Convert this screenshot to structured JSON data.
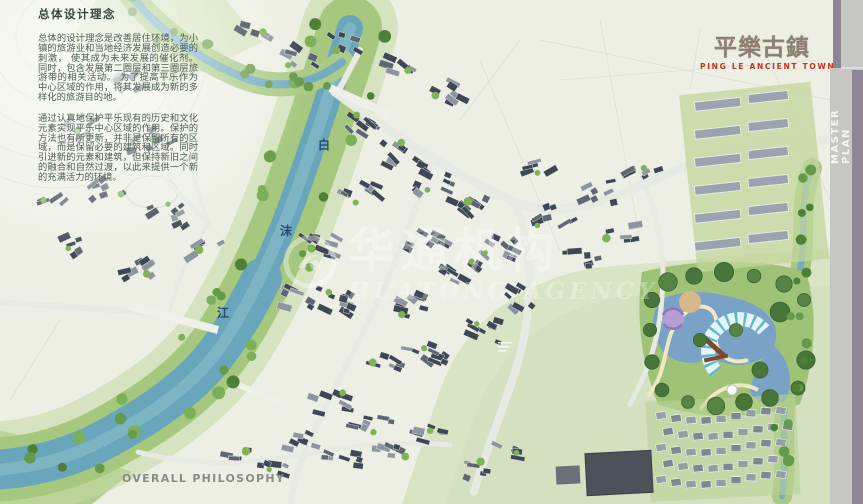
{
  "page": {
    "background": "#edefe4"
  },
  "intro": {
    "heading": "总体设计理念",
    "paragraph1": "总体的设计理念是改善居住环境，为小镇的旅游业和当地经济发展创造必要的刺激， 使其成为未来发展的催化剂。同时，包含发展第二圈层和第三圈层旅游带的相关活动。 为了提高平乐作为中心区域的作用，将其发展成为新的多样化的旅游目的地。",
    "paragraph2": "通过认真地保护平乐现有的历史和文化元素实现平乐中心区域的作用。保护的方法也有所更新，并非是保留所有的区域，而是保留必要的建筑和区域。同时引进新的元素和建筑，但保持新旧之间的融合和自然过渡，以此来提供一个新的充满活力的环境。"
  },
  "brand": {
    "title_cn": "平樂古鎮",
    "subtitle_en": "PING LE ANCIENT TOWN",
    "accent_color": "#c5311d"
  },
  "sidebar": {
    "label": "MASTER PLAN",
    "accent_color": "#8e8695",
    "bar_color": "#c6c6c4"
  },
  "map": {
    "river_labels": {
      "bai": "白",
      "mo": "沫",
      "jiang": "江"
    },
    "river_color": "#6aa6bb"
  },
  "watermark": {
    "logo": "circle-swirl-logo",
    "text_cn": "华通机构",
    "text_en": "HUATONG AGENCY"
  },
  "footer": {
    "label": "OVERALL PHILOSOPHY"
  }
}
